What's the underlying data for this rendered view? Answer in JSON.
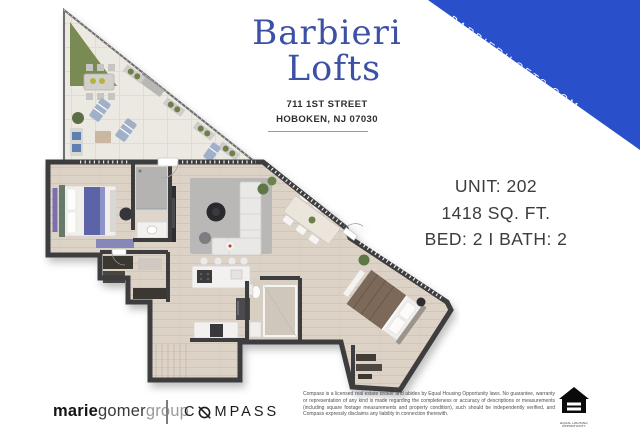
{
  "banner": {
    "text": "BARBIERILOFTS.COM",
    "color": "#2a4fca"
  },
  "header": {
    "title_line1": "Barbieri",
    "title_line2": "Lofts",
    "title_color": "#3c50a5",
    "address_line1": "711 1ST STREET",
    "address_line2": "HOBOKEN, NJ 07030"
  },
  "unit_info": {
    "unit": "UNIT: 202",
    "sqft": "1418 SQ. FT.",
    "bed_bath": "BED: 2 I BATH: 2"
  },
  "floor_plan": {
    "description": "3D rendered floor plan: triangular wrap-around terrace with grass patch and outdoor furniture, master bedroom with bath and walk-in closet, open living/dining room, kitchen with island, second bathroom, angled second bedroom at lower right",
    "colors": {
      "walls": "#3e3e40",
      "wood_floor": "#dcd2c6",
      "terrace_floor": "#ece8e2",
      "grass": "#7a8a52",
      "rug": "#b9b8b6",
      "bed1_accent": "#5c63a6",
      "bed2_duvet": "#7b695a"
    }
  },
  "footer": {
    "brokerage": {
      "part1": "marie",
      "part2": "gomer",
      "part3": "group"
    },
    "compass": {
      "prefix": "C",
      "suffix": "MPASS"
    },
    "disclaimer": "Compass is a licensed real estate broker and abides by Equal Housing Opportunity laws. No guarantee, warranty or representation of any kind is made regarding the completeness or accuracy of descriptions or measurements (including square footage measurements and property condition), such should be independently verified, and Compass expressly disclaims any liability in connection therewith.",
    "equal_housing": "EQUAL HOUSING OPPORTUNITY"
  }
}
